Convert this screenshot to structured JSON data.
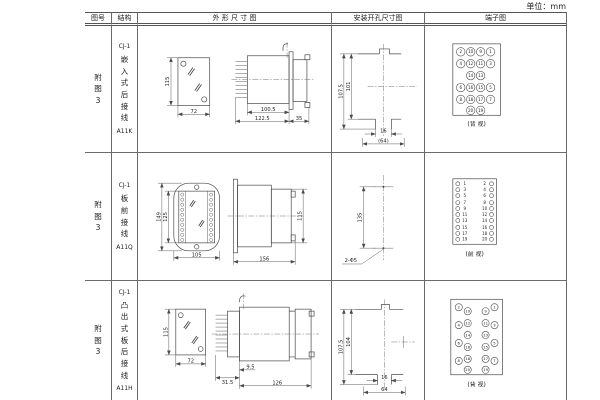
{
  "page": {
    "unit_label": "单位：mm"
  },
  "headers": {
    "fig_no": "图号",
    "structure": "结构",
    "outline": "外 形 尺 寸 图",
    "install": "安装开孔尺寸图",
    "terminal": "端子图"
  },
  "rows": [
    {
      "fig_label": "附图3",
      "model": "CJ-1",
      "mount": "嵌入式后接线",
      "code": "A11K",
      "outline": {
        "front_h": "115",
        "front_w": "72",
        "body_d": "100.5",
        "total_d": "122.5",
        "flange_d": "35"
      },
      "install": {
        "outer_h": "107.5",
        "inner_h": "101",
        "slot_w": "16",
        "cut_w": "(64)"
      },
      "terminal": {
        "caption": "(背 视)",
        "r": 4.3,
        "fs": 4,
        "points": [
          {
            "x": 36,
            "y": 26,
            "n": "2"
          },
          {
            "x": 46,
            "y": 26,
            "n": "10"
          },
          {
            "x": 56,
            "y": 26,
            "n": "9"
          },
          {
            "x": 66,
            "y": 26,
            "n": "1"
          },
          {
            "x": 36,
            "y": 38,
            "n": "4"
          },
          {
            "x": 46,
            "y": 38,
            "n": "12"
          },
          {
            "x": 56,
            "y": 38,
            "n": "11"
          },
          {
            "x": 66,
            "y": 38,
            "n": "3"
          },
          {
            "x": 46,
            "y": 50,
            "n": "14"
          },
          {
            "x": 56,
            "y": 50,
            "n": "13"
          },
          {
            "x": 36,
            "y": 62,
            "n": "6"
          },
          {
            "x": 46,
            "y": 62,
            "n": "16"
          },
          {
            "x": 56,
            "y": 62,
            "n": "15"
          },
          {
            "x": 66,
            "y": 62,
            "n": "5"
          },
          {
            "x": 36,
            "y": 74,
            "n": "8"
          },
          {
            "x": 46,
            "y": 74,
            "n": "18"
          },
          {
            "x": 56,
            "y": 74,
            "n": "17"
          },
          {
            "x": 66,
            "y": 74,
            "n": "7"
          },
          {
            "x": 46,
            "y": 85,
            "n": "20"
          },
          {
            "x": 56,
            "y": 85,
            "n": "19"
          }
        ]
      }
    },
    {
      "fig_label": "附图3",
      "model": "CJ-1",
      "mount": "板前接线",
      "code": "A11Q",
      "outline": {
        "outer_h": "149",
        "inner_h": "125",
        "front_w": "105",
        "depth": "156",
        "side_h": "115"
      },
      "install": {
        "hole_span": "135",
        "holes": "2-Φ5"
      },
      "terminal": {
        "caption": "(前 视)",
        "r": 2,
        "fs": 4,
        "points": [
          {
            "x": 33,
            "y": 31,
            "n": "1",
            "tx": 40
          },
          {
            "x": 67,
            "y": 31,
            "n": "2",
            "tx": 60
          },
          {
            "x": 33,
            "y": 37,
            "n": "3",
            "tx": 40
          },
          {
            "x": 67,
            "y": 37,
            "n": "4",
            "tx": 60
          },
          {
            "x": 33,
            "y": 43,
            "n": "5",
            "tx": 40
          },
          {
            "x": 67,
            "y": 43,
            "n": "6",
            "tx": 60
          },
          {
            "x": 33,
            "y": 50,
            "n": "7",
            "tx": 40
          },
          {
            "x": 67,
            "y": 50,
            "n": "8",
            "tx": 60
          },
          {
            "x": 33,
            "y": 56,
            "n": "9",
            "tx": 40
          },
          {
            "x": 67,
            "y": 56,
            "n": "10",
            "tx": 60
          },
          {
            "x": 33,
            "y": 62,
            "n": "11",
            "tx": 40
          },
          {
            "x": 67,
            "y": 62,
            "n": "12",
            "tx": 60
          },
          {
            "x": 33,
            "y": 68,
            "n": "13",
            "tx": 40
          },
          {
            "x": 67,
            "y": 68,
            "n": "14",
            "tx": 60
          },
          {
            "x": 33,
            "y": 75,
            "n": "15",
            "tx": 40
          },
          {
            "x": 67,
            "y": 75,
            "n": "16",
            "tx": 60
          },
          {
            "x": 33,
            "y": 81,
            "n": "17",
            "tx": 40
          },
          {
            "x": 67,
            "y": 81,
            "n": "18",
            "tx": 60
          },
          {
            "x": 33,
            "y": 87,
            "n": "19",
            "tx": 40
          },
          {
            "x": 67,
            "y": 87,
            "n": "20",
            "tx": 60
          }
        ]
      }
    },
    {
      "fig_label": "附图3",
      "model": "CJ-1",
      "mount": "凸出式板后接线",
      "code": "A11H",
      "outline": {
        "front_h": "115",
        "front_w": "72",
        "fin_d": "31.5",
        "step_d": "9.5",
        "body_d": "126"
      },
      "install": {
        "outer_h": "107.5",
        "inner_h": "104",
        "slot_w": "16",
        "cut_w": "64"
      },
      "terminal": {
        "caption": "(背 视)",
        "r": 3.6,
        "fs": 3.8,
        "points": [
          {
            "x": 34,
            "y": 26,
            "n": "2"
          },
          {
            "x": 70,
            "y": 26,
            "n": "1"
          },
          {
            "x": 43,
            "y": 30,
            "n": "10"
          },
          {
            "x": 61,
            "y": 30,
            "n": "9"
          },
          {
            "x": 43,
            "y": 42,
            "n": "12"
          },
          {
            "x": 61,
            "y": 42,
            "n": "11"
          },
          {
            "x": 34,
            "y": 44,
            "n": "4"
          },
          {
            "x": 70,
            "y": 44,
            "n": "3"
          },
          {
            "x": 43,
            "y": 54,
            "n": "14"
          },
          {
            "x": 61,
            "y": 54,
            "n": "13"
          },
          {
            "x": 34,
            "y": 62,
            "n": "6"
          },
          {
            "x": 70,
            "y": 62,
            "n": "5"
          },
          {
            "x": 43,
            "y": 66,
            "n": "16"
          },
          {
            "x": 61,
            "y": 66,
            "n": "15"
          },
          {
            "x": 43,
            "y": 78,
            "n": "18"
          },
          {
            "x": 61,
            "y": 78,
            "n": "17"
          },
          {
            "x": 34,
            "y": 80,
            "n": "8"
          },
          {
            "x": 70,
            "y": 80,
            "n": "7"
          },
          {
            "x": 43,
            "y": 89,
            "n": "20"
          },
          {
            "x": 61,
            "y": 89,
            "n": "19"
          }
        ]
      }
    }
  ]
}
